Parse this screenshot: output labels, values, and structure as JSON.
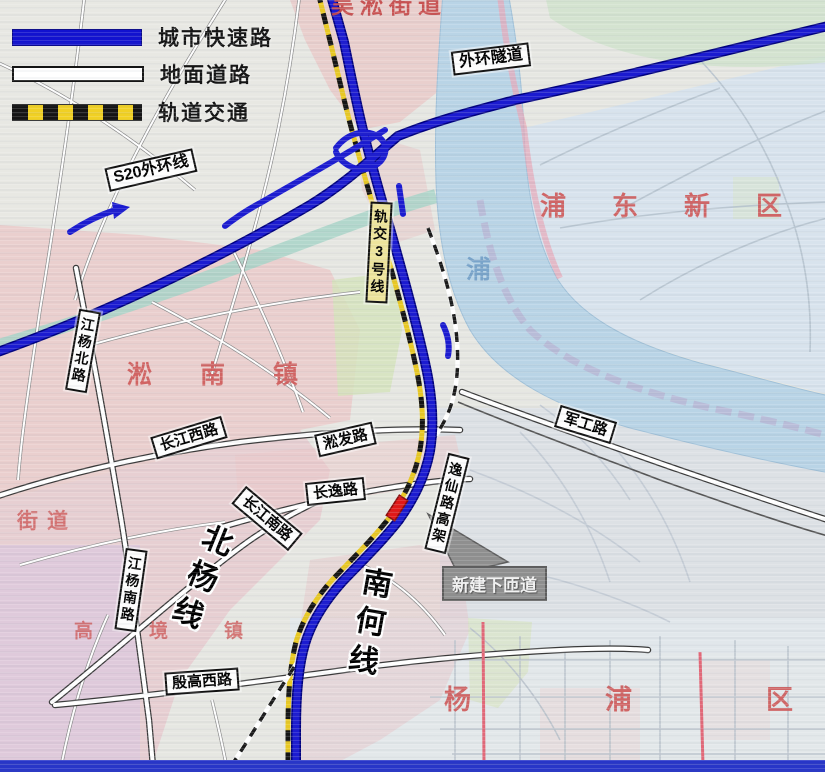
{
  "legend": {
    "items": [
      {
        "id": "expressway",
        "label": "城市快速路"
      },
      {
        "id": "surface-road",
        "label": "地面道路"
      },
      {
        "id": "rail-transit",
        "label": "轨道交通"
      }
    ]
  },
  "road_labels": {
    "s20_outer_ring": "S20外环线",
    "outer_ring_tunnel": "外环隧道",
    "metro_line3": "轨交3号线",
    "jiangyang_north_rd": "江杨北路",
    "changjiang_west_rd": "长江西路",
    "songfa_rd": "淞发路",
    "changyi_rd": "长逸路",
    "changjiang_south_rd": "长江南路",
    "jungong_rd": "军工路",
    "jiangyang_south_rd": "江杨南路",
    "yixian_elevated": "逸仙路高架",
    "yingao_west_rd": "殷高西路"
  },
  "rail_labels": {
    "beiyang_line": "北杨线",
    "nanhe_line": "南何线"
  },
  "district_labels": {
    "pudong": "浦东新区",
    "songnan": "淞南镇",
    "yangpu": "杨浦区",
    "gaojing": "高境镇",
    "wusong": "吴淞街道",
    "jiedao": "街道"
  },
  "annotation": {
    "new_ramp": "新建下匝道"
  },
  "water_labels": {
    "river_char": "浦"
  },
  "colors": {
    "expressway_blue": "#1414cc",
    "rail_yellow": "#f0d024",
    "water_blue": "#b9d4e6",
    "district_red": "#cf5b5b",
    "marker_red": "#e01818",
    "callout_gray": "#8f8f8f"
  }
}
